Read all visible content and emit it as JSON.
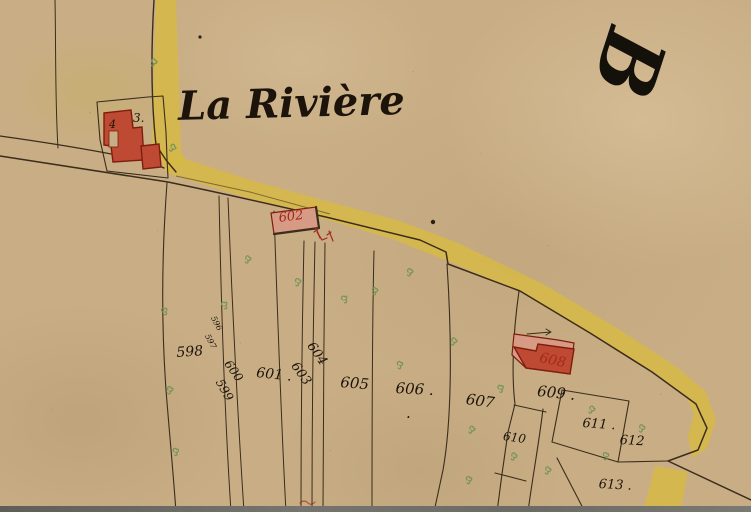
{
  "map": {
    "title": "La Rivière",
    "section_letter": "B",
    "labels": [
      {
        "text": "598",
        "x": 176,
        "y": 346,
        "rot": -4,
        "size": 14,
        "color": "ink"
      },
      {
        "text": "599",
        "x": 224,
        "y": 377,
        "rot": 60,
        "size": 12,
        "color": "ink"
      },
      {
        "text": "600",
        "x": 232,
        "y": 358,
        "rot": 55,
        "size": 12,
        "color": "ink"
      },
      {
        "text": "601 .",
        "x": 257,
        "y": 366,
        "rot": 6,
        "size": 14,
        "color": "ink"
      },
      {
        "text": "603",
        "x": 299,
        "y": 360,
        "rot": 55,
        "size": 13,
        "color": "ink"
      },
      {
        "text": "604",
        "x": 315,
        "y": 340,
        "rot": 55,
        "size": 13,
        "color": "ink"
      },
      {
        "text": "605",
        "x": 341,
        "y": 375,
        "rot": 5,
        "size": 15,
        "color": "ink"
      },
      {
        "text": "606 .",
        "x": 396,
        "y": 381,
        "rot": 3,
        "size": 15,
        "color": "ink"
      },
      {
        "text": ".",
        "x": 406,
        "y": 406,
        "rot": 0,
        "size": 15,
        "color": "ink"
      },
      {
        "text": "607",
        "x": 467,
        "y": 392,
        "rot": 8,
        "size": 15,
        "color": "ink"
      },
      {
        "text": "608",
        "x": 541,
        "y": 351,
        "rot": 12,
        "size": 14,
        "color": "red"
      },
      {
        "text": "609 .",
        "x": 538,
        "y": 384,
        "rot": 6,
        "size": 15,
        "color": "ink"
      },
      {
        "text": "610",
        "x": 504,
        "y": 430,
        "rot": 8,
        "size": 12,
        "color": "ink"
      },
      {
        "text": "611 .",
        "x": 583,
        "y": 417,
        "rot": 4,
        "size": 13,
        "color": "ink"
      },
      {
        "text": "612",
        "x": 620,
        "y": 434,
        "rot": 3,
        "size": 13,
        "color": "ink"
      },
      {
        "text": "613 .",
        "x": 599,
        "y": 478,
        "rot": 3,
        "size": 13,
        "color": "ink"
      },
      {
        "text": "596",
        "x": 216,
        "y": 315,
        "rot": 62,
        "size": 8,
        "color": "ink"
      },
      {
        "text": "597",
        "x": 210,
        "y": 333,
        "rot": 62,
        "size": 8,
        "color": "ink"
      },
      {
        "text": "602",
        "x": 278,
        "y": 212,
        "rot": -7,
        "size": 13,
        "color": "red"
      },
      {
        "text": "4",
        "x": 109,
        "y": 119,
        "rot": 0,
        "size": 11,
        "color": "ink"
      },
      {
        "text": "3.",
        "x": 133,
        "y": 112,
        "rot": 0,
        "size": 12,
        "color": "ink"
      }
    ],
    "colors": {
      "parchment": "#c9ae85",
      "ink": "#3a2d1c",
      "ink_text": "#1c130a",
      "road_yellow": "#d7ba43",
      "building_red": "#bf4a33",
      "building_red_light": "#d79a84",
      "building_outline": "#7e1d0e",
      "label_red": "#a5291b",
      "vegetation_green": "#769455"
    },
    "icons": [
      "vegetation-mark-icon",
      "red-tick-mark-icon",
      "survey-arrow-icon"
    ]
  }
}
